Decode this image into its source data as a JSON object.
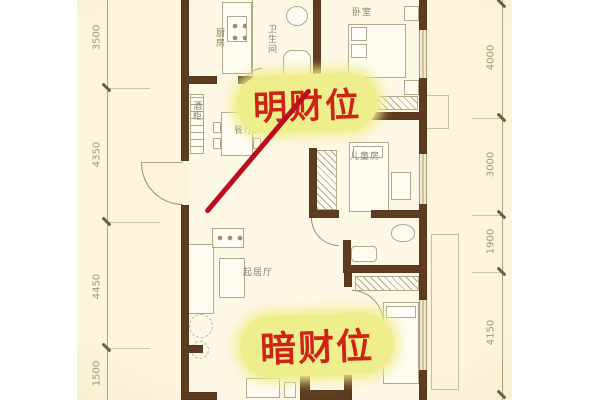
{
  "annotations": {
    "bright_wealth_label": "明财位",
    "dark_wealth_label": "暗财位"
  },
  "rooms": {
    "kitchen": "厨房",
    "bathroom": "卫生间",
    "master_bedroom": "卧室",
    "wine_cabinet": "酒柜",
    "dining_room": "餐厅",
    "kids_room": "儿童房",
    "living_room": "起居厅"
  },
  "dimensions": {
    "left": [
      "3500",
      "4350",
      "4450",
      "1500"
    ],
    "right": [
      "4000",
      "3000",
      "1900",
      "4150"
    ]
  },
  "colors": {
    "canvas_cream": "#faf2d8",
    "wall_brown": "#5e3c20",
    "floor_line": "#b2a88c",
    "dim_text": "#a4976f",
    "highlight_yellow": "#efee8d",
    "annotation_red": "#ce2317",
    "red_line": "#ba0f1e"
  }
}
